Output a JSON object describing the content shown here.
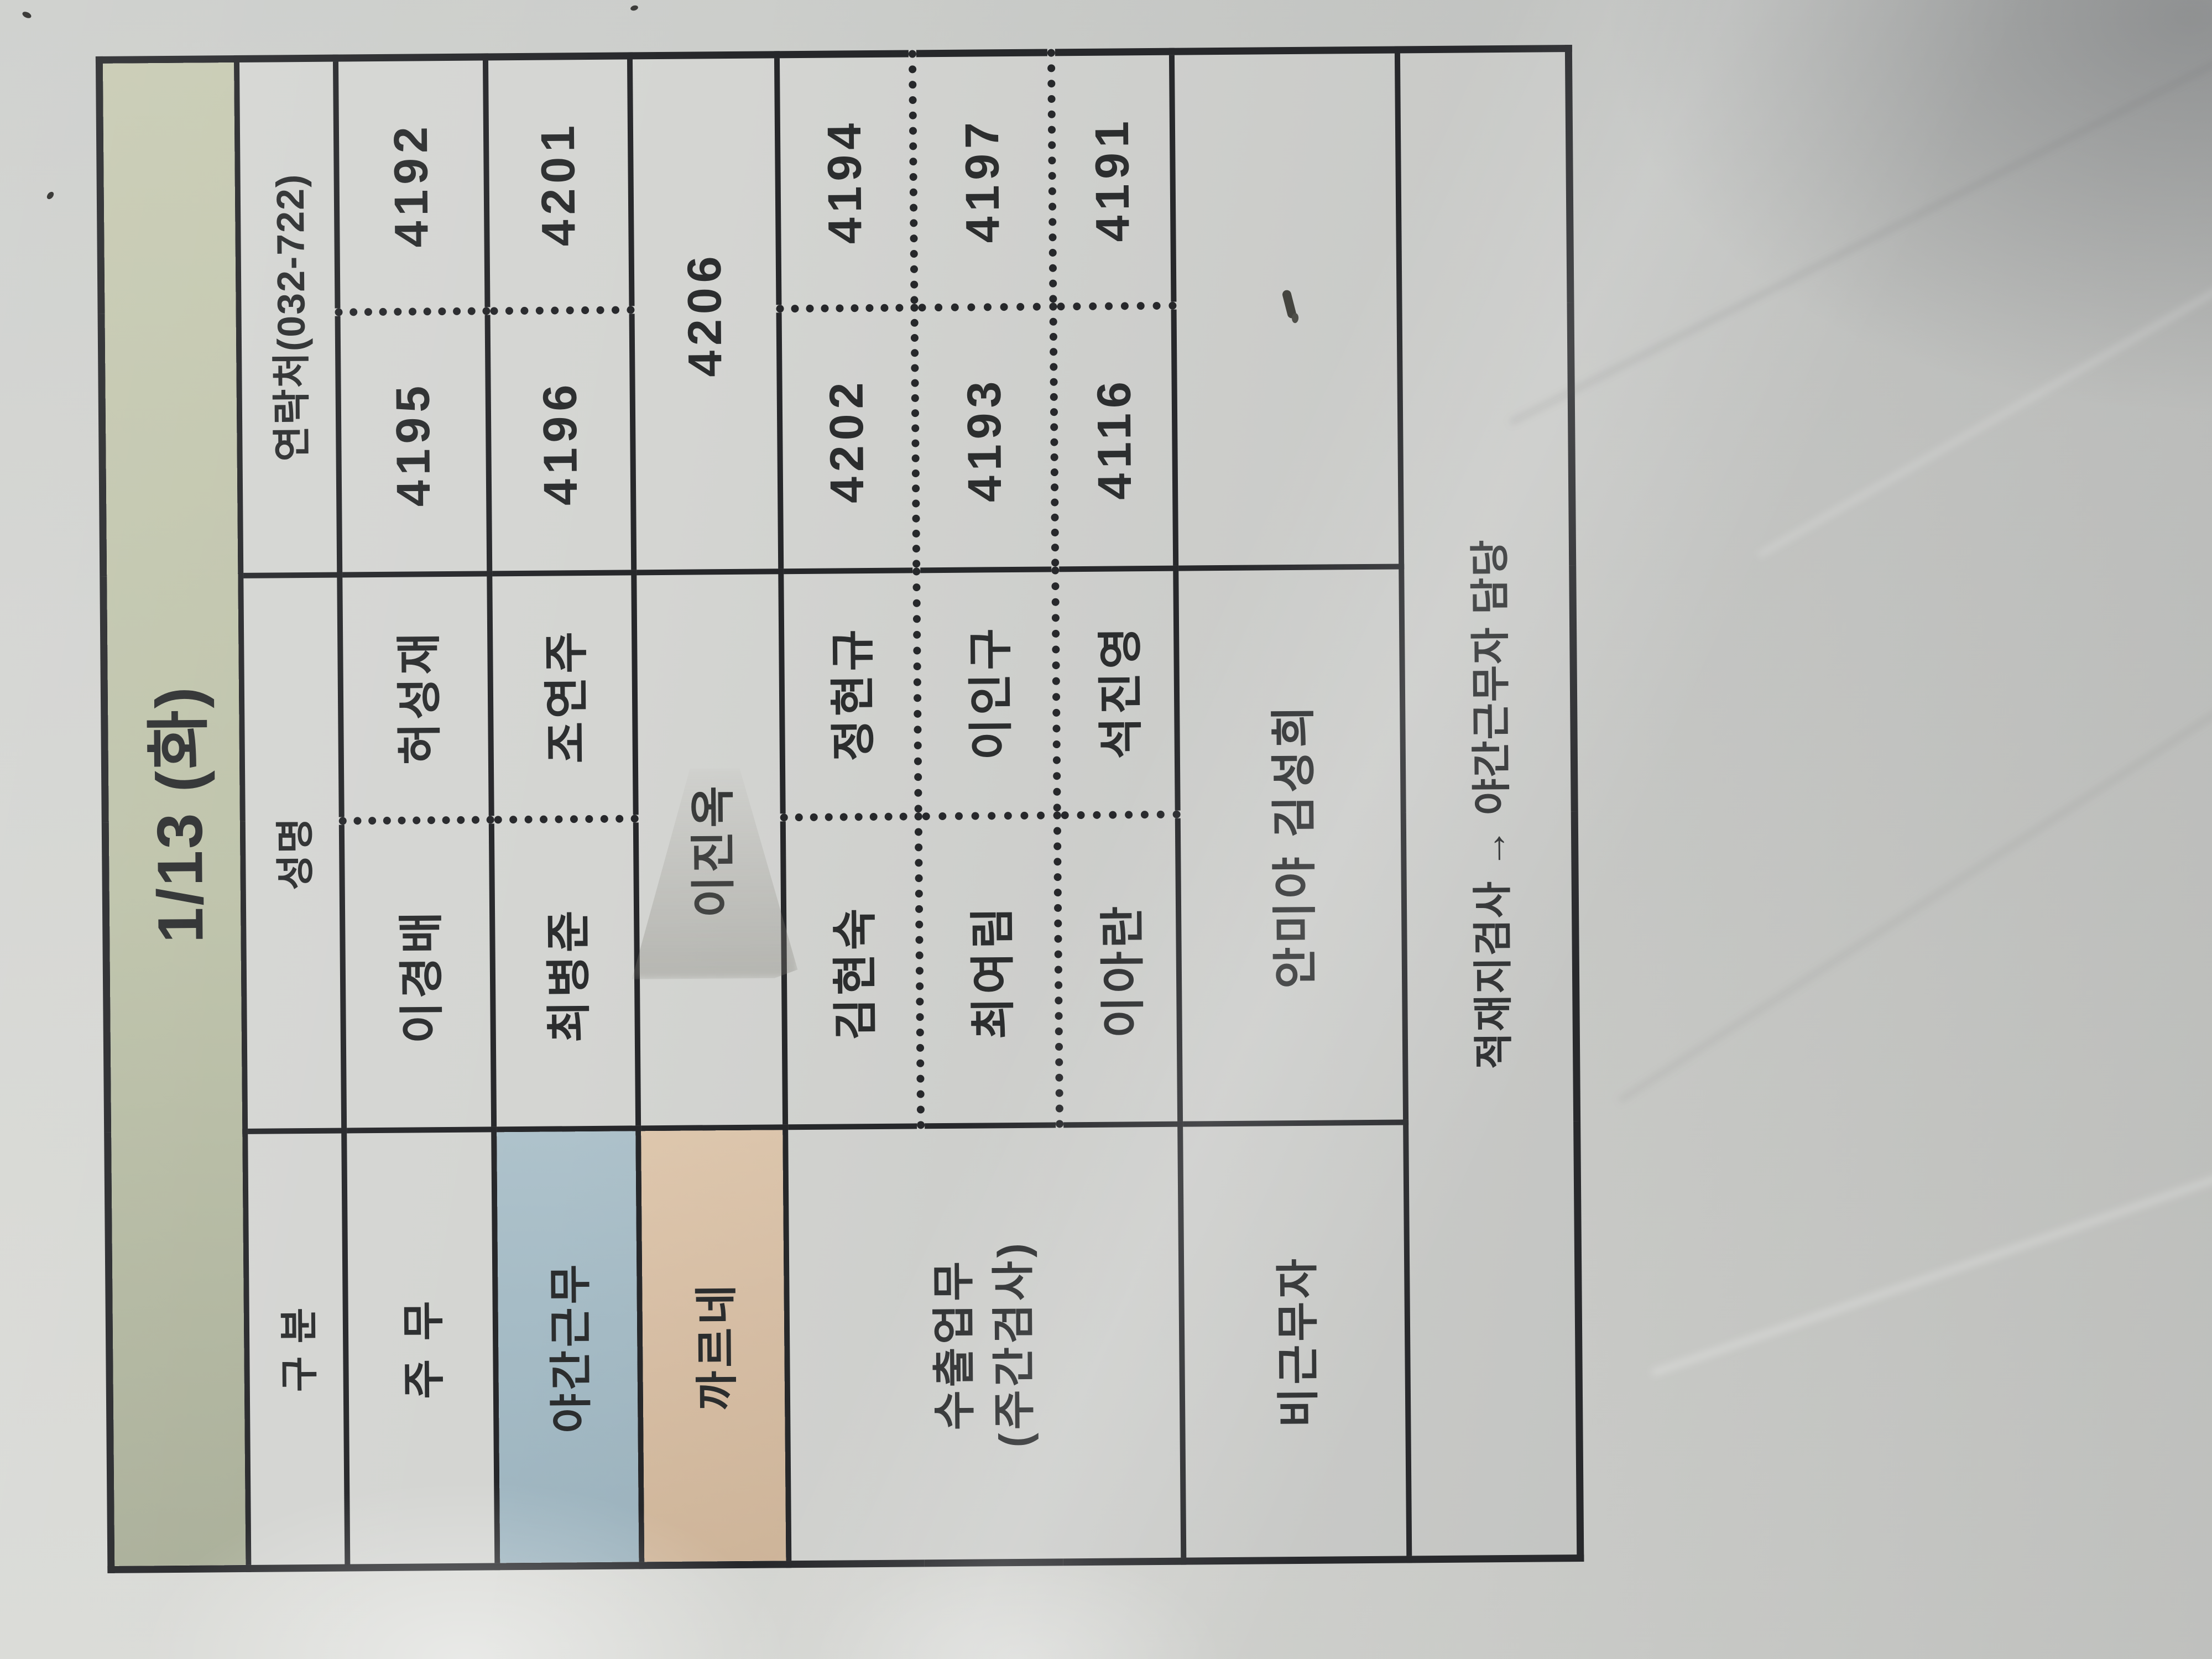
{
  "header": {
    "title": "1/13 (화)"
  },
  "column_headers": {
    "category": "구 분",
    "name": "성명",
    "contact": "연락처(032-722)"
  },
  "rows": {
    "jumu": {
      "label": "주 무",
      "name1": "이경배",
      "name2": "허성재",
      "num1": "4195",
      "num2": "4192"
    },
    "night": {
      "label": "야간근무",
      "name1": "최병준",
      "name2": "조연주",
      "num1": "4196",
      "num2": "4201"
    },
    "carnet": {
      "label": "까르네",
      "name": "이진옥",
      "num": "4206"
    },
    "export": {
      "label_line1": "수출업무",
      "label_line2": "(주간검사)",
      "sub": [
        {
          "name1": "김현숙",
          "name2": "정현규",
          "num1": "4202",
          "num2": "4194"
        },
        {
          "name1": "최여림",
          "name2": "이인구",
          "num1": "4193",
          "num2": "4197"
        },
        {
          "name1": "이아란",
          "name2": "석진영",
          "num1": "4116",
          "num2": "4191"
        }
      ]
    },
    "offduty": {
      "label": "비근무자",
      "names": "안미야 김성희"
    }
  },
  "note": "적재지검사 → 야간근무자 담당",
  "colors": {
    "header_green": "#bcc1a8",
    "night_blue": "#a6bcc6",
    "carnet_tan": "#d9c0a6",
    "line": "#26272a",
    "text": "#2b2d2e",
    "paper": "#d4d5d2"
  }
}
